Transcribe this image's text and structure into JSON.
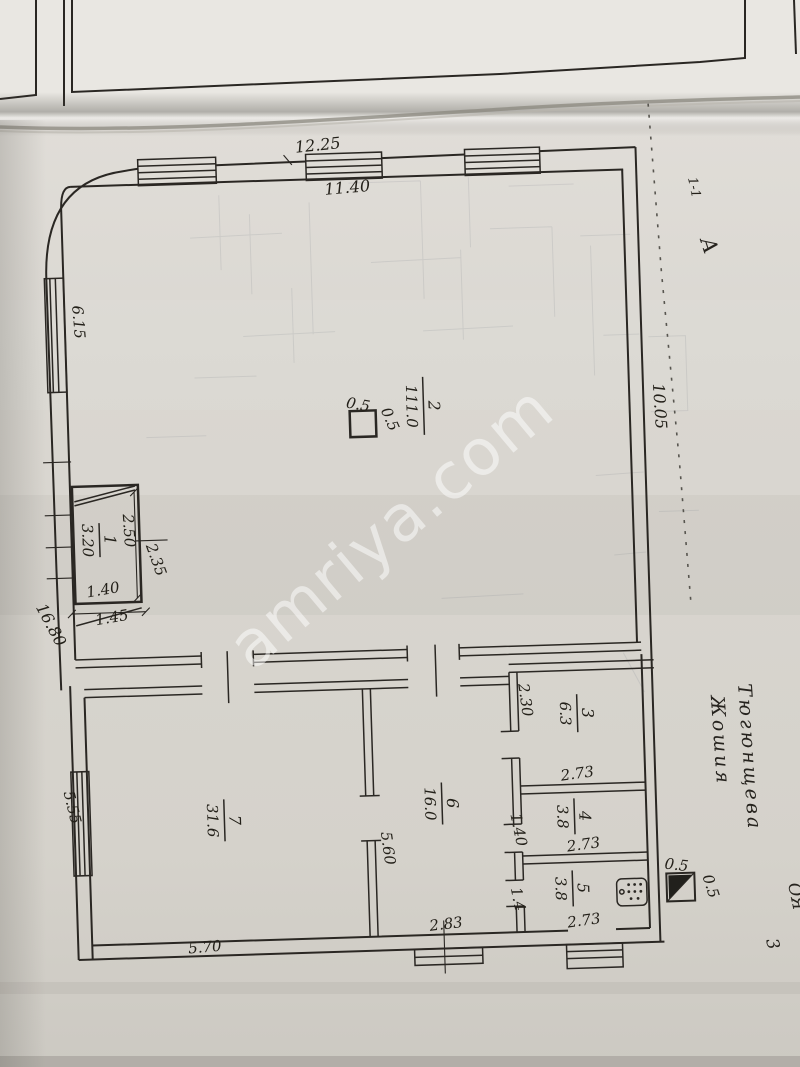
{
  "watermark": {
    "text": "amriya.com"
  },
  "plan": {
    "outer_dimensions": {
      "top_width": "12.25",
      "top_inner_width": "11.40",
      "left_window": "6.15",
      "left_total": "16.80",
      "right_side": "10.05"
    },
    "pillar": {
      "width": "0.5",
      "depth": "0.5"
    },
    "flue": {
      "width": "0.5",
      "depth": "0.5"
    },
    "rooms": [
      {
        "number": "1",
        "area": "3.20",
        "width": "2.50",
        "height": "2.35",
        "door_width": "1.40",
        "door_outer_width": "1.45"
      },
      {
        "number": "2",
        "area": "111.0"
      },
      {
        "number": "3",
        "area": "6.3",
        "width": "2.73",
        "height": "2.30"
      },
      {
        "number": "4",
        "area": "3.8",
        "width": "2.73",
        "height": "1.40"
      },
      {
        "number": "5",
        "area": "3.8",
        "width": "2.73",
        "height": "1.4"
      },
      {
        "number": "6",
        "area": "16.0",
        "width": "2.83",
        "height": "5.60"
      },
      {
        "number": "7",
        "area": "31.6",
        "width": "5.70",
        "height": "5.55"
      }
    ],
    "annotations": {
      "section_mark": "1-1",
      "axis_letter": "А",
      "owner_name_line1": "Тюгюнщева",
      "owner_name_line2": "Жошия",
      "corner_initials": "ОЯ",
      "sheet_number": "3"
    }
  }
}
